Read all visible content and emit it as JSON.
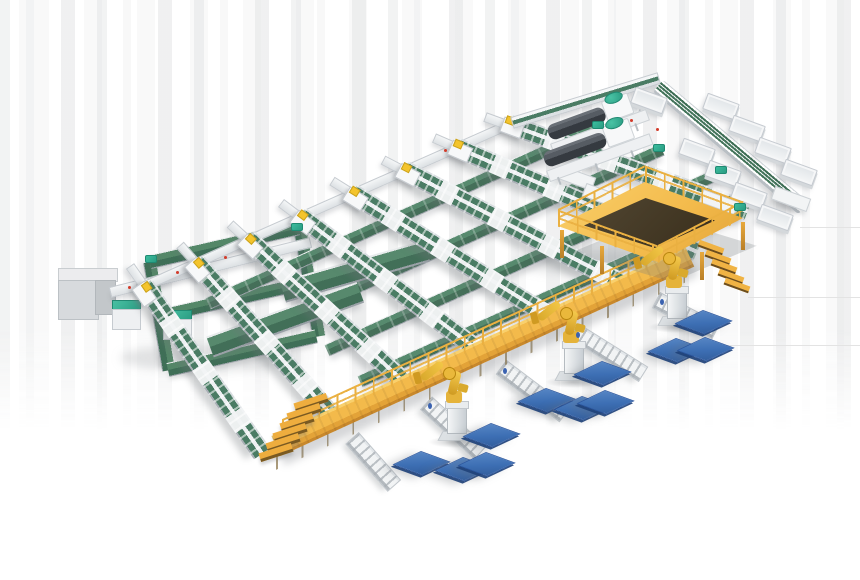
{
  "title": "Automated sorting and palletizing line — isometric factory render",
  "palette": {
    "background": "#ffffff",
    "frame_white": "#f2f4f5",
    "rail_gray": "#c6cbd0",
    "belt_green": "#4a7c64",
    "belt_green_dark": "#3c6b53",
    "teal_accent": "#2fae91",
    "walkway_yellow": "#f3ba4b",
    "walkway_yellow_deep": "#d9952f",
    "railing_yellow": "#eab041",
    "robot_yellow": "#eebc3e",
    "pallet_blue": "#3d6fb4",
    "pallet_blue_dark": "#24509a",
    "machine_dark": "#41464c",
    "shadow": "rgba(120,125,130,0.25)"
  },
  "scene": {
    "sorter_lines": {
      "count": 8,
      "label": "green belt sorter line",
      "belt_color": "#4a7c64"
    },
    "line_heads": {
      "count": 8,
      "label": "infeed head station with yellow clamp"
    },
    "cross_belts": {
      "count": 4,
      "label": "cross transfer belt"
    },
    "wide_belts": {
      "count": 2,
      "label": "wide green transfer belt"
    },
    "spur_conveyors": {
      "count": 5,
      "label": "roller spur conveyor under walkway"
    },
    "walkway": {
      "label": "elevated yellow maintenance walkway",
      "stairs": 1,
      "color": "#f3ba4b"
    },
    "operator_platform": {
      "label": "yellow operator platform with stairs",
      "stairs": 1
    },
    "machines": {
      "count": 2,
      "label": "strapping machine",
      "body_color": "#41464c",
      "cap_color": "#2fae91"
    },
    "trunk_conveyor": {
      "lanes": 4,
      "label": "multi-lane discharge trunk conveyor"
    },
    "totes": {
      "count": 10,
      "label": "white discharge tote bin"
    },
    "side_tables": {
      "count": 3,
      "label": "white accumulation table"
    },
    "robots": {
      "count": 3,
      "label": "yellow palletizing robot arm",
      "color": "#eebc3e"
    },
    "pallets": {
      "count": 11,
      "label": "blue pallet stack",
      "color": "#3d6fb4"
    },
    "cabinets": {
      "gray_count": 1,
      "teal_count": 2,
      "label": "electrical cabinet"
    },
    "return_loop": {
      "strips": 5,
      "label": "green tote return loop"
    },
    "teal_caps": {
      "count": 6
    },
    "red_markers": {
      "count": 6
    },
    "blue_markers": {
      "count": 4
    },
    "background_artifact_lines": {
      "count": 3
    }
  }
}
